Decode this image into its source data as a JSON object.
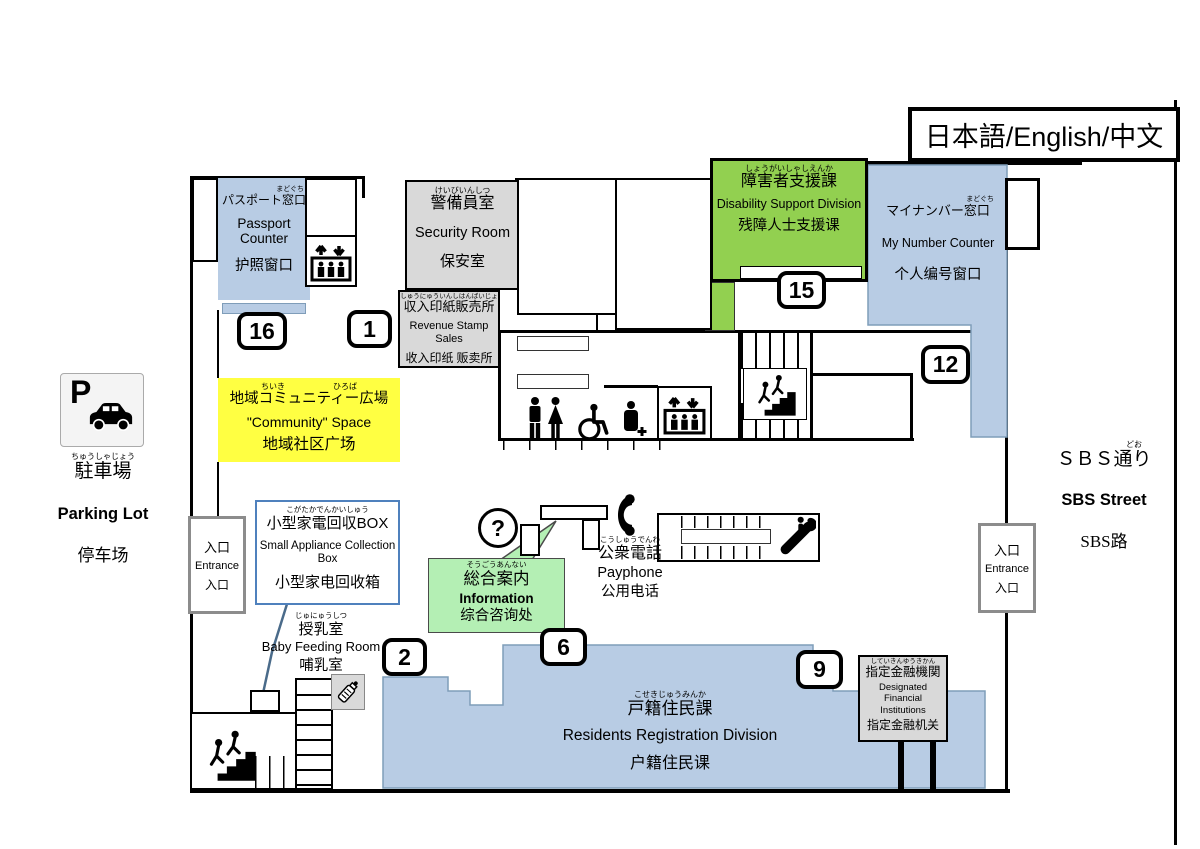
{
  "legend": {
    "language_selector": "日本語/English/中文"
  },
  "areas": {
    "passport": {
      "furigana": "まどぐち",
      "jp": "パスポート窓口",
      "en": "Passport Counter",
      "zh": "护照窗口"
    },
    "security": {
      "furigana": "けいびいんしつ",
      "jp": "警備員室",
      "en": "Security Room",
      "zh": "保安室"
    },
    "revenue_stamp": {
      "furigana": "しゅうにゅういんしはんばいじょ",
      "jp": "収入印紙販売所",
      "en": "Revenue Stamp Sales",
      "zh": "收入印纸 贩卖所"
    },
    "disability": {
      "furigana": "しょうがいしゃしえんか",
      "jp": "障害者支援課",
      "en": "Disability Support Division",
      "zh": "残障人士支援课"
    },
    "my_number": {
      "furigana": "まどぐち",
      "jp": "マイナンバー窓口",
      "en": "My Number Counter",
      "zh": "个人编号窗口"
    },
    "community": {
      "furigana": "ちいき　　　　　　ひろば",
      "jp": "地域コミュニティー広場",
      "en": "\"Community\" Space",
      "zh": "地域社区广场"
    },
    "appliance_box": {
      "furigana": "こがたかでんかいしゅう",
      "jp": "小型家電回収BOX",
      "en": "Small Appliance Collection Box",
      "zh": "小型家电回收箱"
    },
    "information": {
      "furigana": "そうごうあんない",
      "jp": "総合案内",
      "en": "Information",
      "zh": "综合咨询处"
    },
    "payphone": {
      "furigana": "こうしゅうでんわ",
      "jp": "公衆電話",
      "en": "Payphone",
      "zh": "公用电话"
    },
    "baby_room": {
      "furigana": "じゅにゅうしつ",
      "jp": "授乳室",
      "en": "Baby Feeding Room",
      "zh": "哺乳室"
    },
    "residents": {
      "furigana": "こせきじゅうみんか",
      "jp": "戸籍住民課",
      "en": "Residents Registration Division",
      "zh": "户籍住民课"
    },
    "financial": {
      "furigana": "していきんゆうきかん",
      "jp": "指定金融機関",
      "en": "Designated Financial Institutions",
      "zh": "指定金融机关"
    },
    "parking": {
      "furigana": "ちゅうしゃじょう",
      "jp": "駐車場",
      "en": "Parking Lot",
      "zh": "停车场"
    },
    "sbs_street": {
      "furigana": "どお",
      "jp": "ＳＢＳ通り",
      "en": "SBS Street",
      "zh": "SBS路"
    },
    "entrance": {
      "jp": "入口",
      "en": "Entrance",
      "zh": "入口"
    }
  },
  "counter_badges": {
    "passport": "16",
    "revenue_stamp": "1",
    "disability": "15",
    "my_number": "12",
    "residents_left": "2",
    "residents_center": "6",
    "residents_right": "9"
  },
  "icons": {
    "parking": "P with car",
    "elevator": "up-down arrows over passengers",
    "stairs": "people climbing steps",
    "escalator": "person on moving stairway",
    "toilet_men": "man figure",
    "toilet_women": "woman figure",
    "wheelchair": "wheelchair user",
    "multipurpose_toilet": "person with cross",
    "payphone": "telephone handset",
    "information": "question mark in circle",
    "baby_bottle": "baby bottle"
  },
  "colors": {
    "counter_blue": "#b8cce4",
    "division_green": "#92d050",
    "info_green": "#b4efb4",
    "community_yellow": "#ffff42",
    "room_gray": "#d9d9d9",
    "appliance_border": "#4f81bd",
    "blue_outline": "#7f9db9"
  }
}
